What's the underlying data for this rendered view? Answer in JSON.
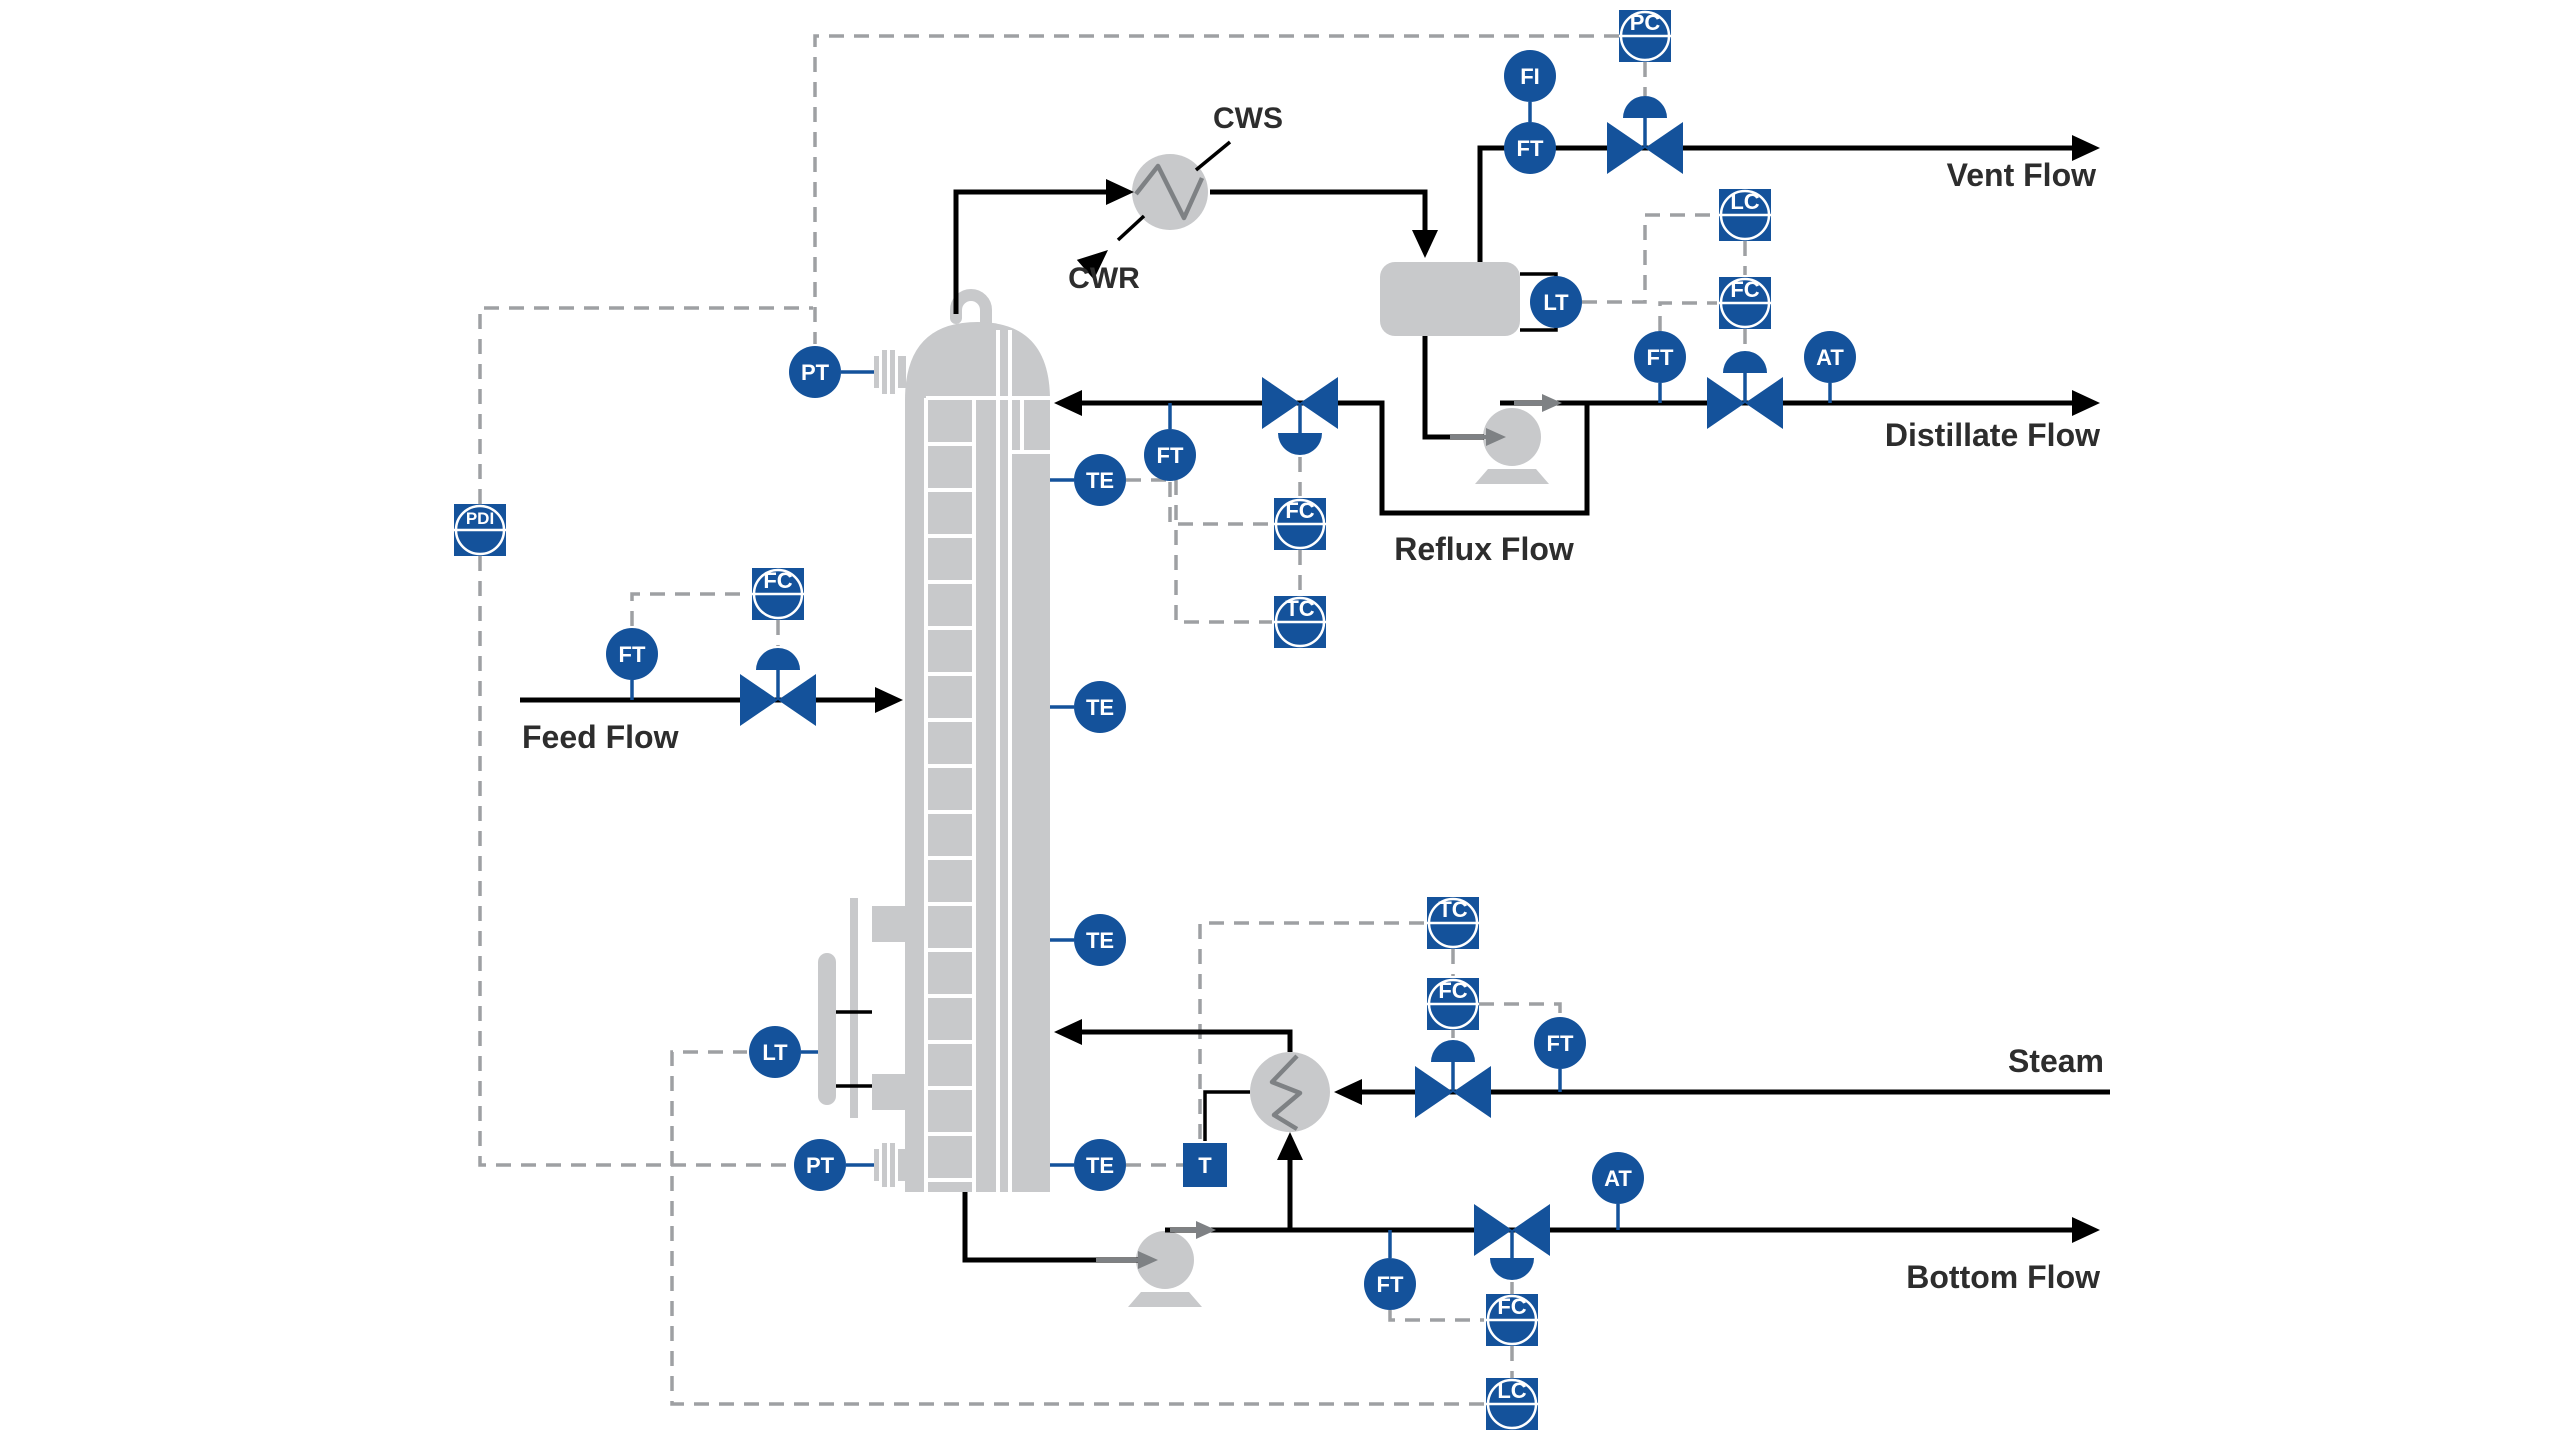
{
  "labels": {
    "feed": "Feed Flow",
    "vent": "Vent Flow",
    "distillate": "Distillate Flow",
    "reflux": "Reflux Flow",
    "bottom": "Bottom Flow",
    "steam": "Steam",
    "cws": "CWS",
    "cwr": "CWR"
  },
  "instruments": {
    "pc_vent": "PC",
    "fi_vent": "FI",
    "ft_vent": "FT",
    "lt_drum": "LT",
    "lc_distillate": "LC",
    "fc_distillate": "FC",
    "ft_distillate": "FT",
    "at_distillate": "AT",
    "pt_top": "PT",
    "te_top": "TE",
    "ft_reflux": "FT",
    "fc_reflux": "FC",
    "tc_reflux": "TC",
    "pdi_column": "PDI",
    "ft_feed": "FT",
    "fc_feed": "FC",
    "te_upper_mid": "TE",
    "te_lower_mid": "TE",
    "te_bottom": "TE",
    "lt_bottom": "LT",
    "pt_bottom": "PT",
    "tc_steam": "TC",
    "fc_steam": "FC",
    "ft_steam": "FT",
    "steam_trap": "T",
    "ft_bottom": "FT",
    "at_bottom": "AT",
    "fc_bottom": "FC",
    "lc_bottom": "LC"
  },
  "colors": {
    "instrument_blue": "#14529B",
    "equipment_gray": "#C8C9CB",
    "detail_gray": "#7E8184",
    "signal_gray": "#9EA0A3",
    "process_black": "#000000",
    "label_text": "#2D2D2D",
    "background": "#FFFFFF"
  }
}
